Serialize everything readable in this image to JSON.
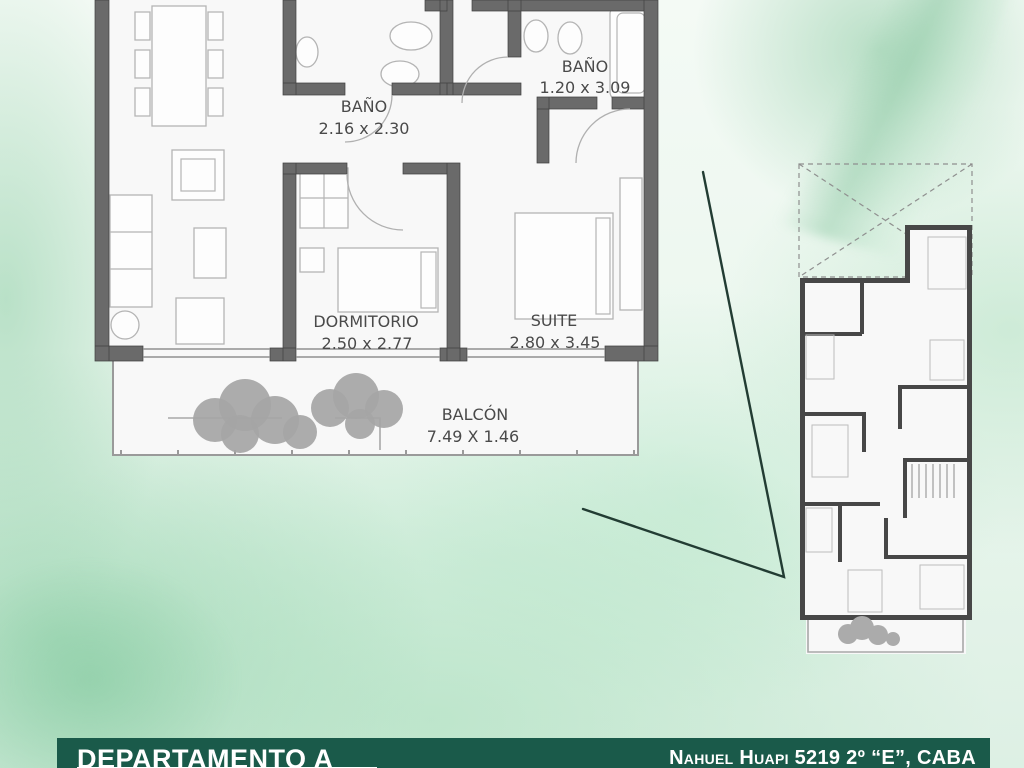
{
  "footer": {
    "title": "DEPARTAMENTO A",
    "address": "Nahuel Huapi 5219 2º “E”, CABA"
  },
  "floor_plan": {
    "rooms": [
      {
        "name": "BAÑO",
        "dimensions": "2.16 x 2.30"
      },
      {
        "name": "BAÑO",
        "dimensions": "1.20 x 3.09"
      },
      {
        "name": "DORMITORIO",
        "dimensions": "2.50 x 2.77"
      },
      {
        "name": "SUITE",
        "dimensions": "2.80 x 3.45"
      },
      {
        "name": "BALCÓN",
        "dimensions": "7.49 X 1.46"
      }
    ]
  },
  "colors": {
    "footer_green": "#1a5a4a",
    "wall_gray": "#6a6a6a",
    "mini_wall_gray": "#474747",
    "background_mint": "#cdeadb",
    "connector_dark": "#223c33",
    "label_gray": "#4a4a4a"
  }
}
